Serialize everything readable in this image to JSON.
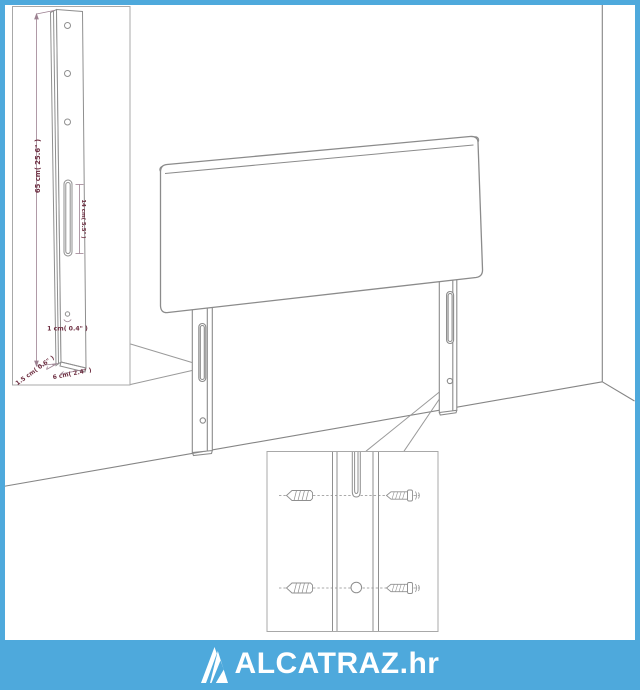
{
  "brand": {
    "name": "ALCATRAZ.hr"
  },
  "colors": {
    "accent_blue": "#4ea9dc",
    "drawing_line": "#8b8b8b",
    "dimension_line": "#9c8191",
    "dimension_text": "#6e2f42",
    "inset_border": "#a8a8a8",
    "background": "#ffffff",
    "logo_text": "#ffffff"
  },
  "icons": [
    {
      "name": "brand-triangle-a-icon",
      "shape": "stylized-letter-A-triangle"
    }
  ],
  "leg_detail_inset": {
    "height_label": "65 cm( 25.6\" )",
    "slot_label": "14 cm( 5.5\" )",
    "hole_label": "1 cm( 0.4\" )",
    "thickness_label": "1.5 cm( 0.6\" )",
    "width_label": "6 cm( 2.4\" )"
  }
}
